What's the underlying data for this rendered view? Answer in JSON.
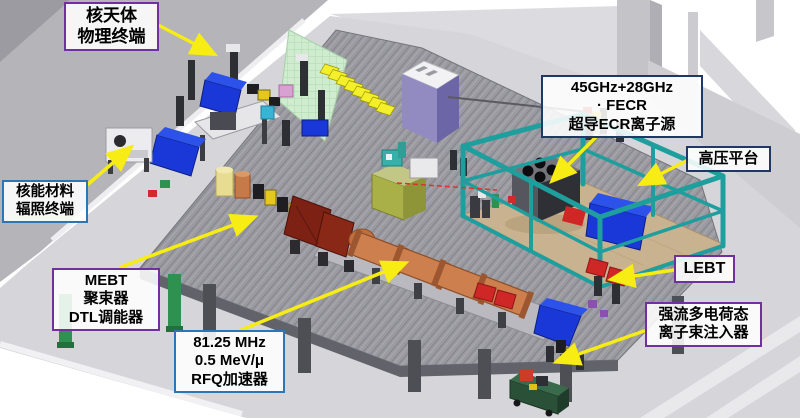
{
  "callouts": [
    {
      "id": "astro-terminal",
      "lines": [
        "核天体",
        "物理终端"
      ],
      "border": "purple"
    },
    {
      "id": "material-terminal",
      "lines": [
        "核能材料",
        "辐照终端"
      ],
      "border": "blue"
    },
    {
      "id": "mebt",
      "lines": [
        "MEBT",
        "聚束器",
        "DTL调能器"
      ],
      "border": "purple"
    },
    {
      "id": "rfq",
      "lines": [
        "81.25 MHz",
        "0.5 MeV/μ",
        "RFQ加速器"
      ],
      "border": "blue"
    },
    {
      "id": "fecr",
      "lines": [
        "45GHz+28GHz",
        "· FECR",
        "超导ECR离子源"
      ],
      "border": "navy"
    },
    {
      "id": "hv-platform",
      "lines": [
        "高压平台"
      ],
      "border": "navy"
    },
    {
      "id": "lebt",
      "lines": [
        "LEBT"
      ],
      "border": "purple"
    },
    {
      "id": "injector",
      "lines": [
        "强流多电荷态",
        "离子束注入器"
      ],
      "border": "purple"
    }
  ],
  "colors": {
    "callout-purple": "#7030a0",
    "callout-blue": "#2e75b6",
    "callout-navy": "#1f3864",
    "arrow-yellow": "#f7ec13",
    "platform-teal": "#1f9e9e",
    "hv-floor-tan": "#c9b28f",
    "dipole-blue": "#1a38d8",
    "rfq-copper": "#cd7f4e",
    "dtl-maroon": "#7c2113",
    "magnet-red": "#cf2626",
    "quad-yellow": "#e6c71e",
    "mat-green": "#cfeccf",
    "stairs-yellow": "#f3ef2a",
    "cabinet-purple": "#928bc2",
    "mesh-gray": "#9a9aa0",
    "floor-gray": "#d6d6da",
    "wall-gray": "#b4b4b9",
    "cart-green": "#2b5038",
    "laser-red": "#e03030"
  }
}
